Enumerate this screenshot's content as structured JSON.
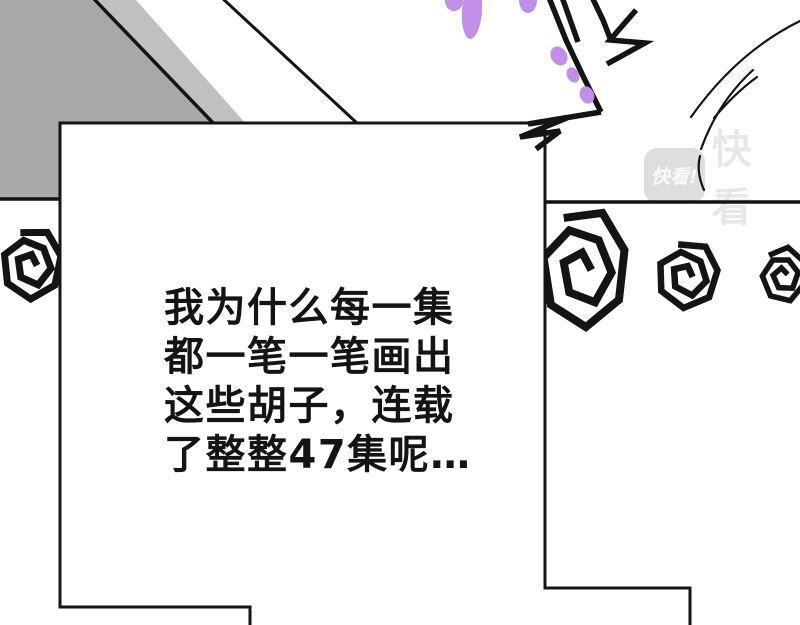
{
  "page": {
    "type": "comic-panel",
    "app": "Kuaikan Manhua reader page"
  },
  "colors": {
    "ink": "#141414",
    "panel_gray": "#a8a8a8",
    "shadow_gray": "#aeaeae",
    "purple": "#c28fe8",
    "paper": "#ffffff",
    "watermark_box": "rgba(0,0,0,0.13)",
    "watermark_text": "rgba(255,255,255,0.85)",
    "watermark_brand": "rgba(0,0,0,0.095)"
  },
  "speech_bubble": {
    "lines": [
      "我为什么每一集",
      "都一笔一笔画出",
      "这些胡子，连载",
      "了整整47集呢…"
    ]
  },
  "watermark": {
    "logo_text": "快看!",
    "brand_text": "快看"
  }
}
